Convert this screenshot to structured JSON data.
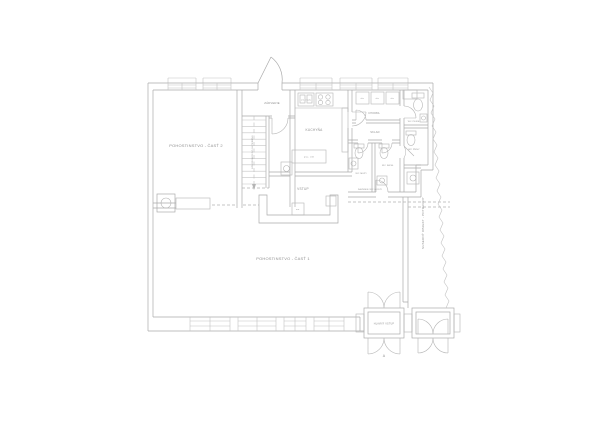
{
  "drawing": {
    "kind": "floor-plan",
    "colors": {
      "background": "#ffffff",
      "wall_line": "#ababab",
      "fixture_line": "#b5b5b5",
      "text": "#8f8f8f"
    },
    "labels": {
      "room_part2": "POHOSTINSTVO - ČASŤ 2",
      "room_part1": "POHOSTINSTVO - ČASŤ 1",
      "vestibule": "ZÁDVERIE",
      "kitchen": "KUCHYŇA",
      "entry": "VSTUP",
      "corridor": "CHODBA",
      "storage": "SKLAD",
      "wc_men": "WC MUŽI",
      "wc_disabled": "WC IMOB.",
      "wc_women": "WC ŽENY",
      "wc_staff": "WC PERS.",
      "back_area": "ZÁZEMIE WC HOSTÍ",
      "staircase": "SCHODISKO DO SUTERÉNU",
      "neighbor_building": "SUSEDNÝ OBJEKT - POTRAVINY",
      "main_entrance": "HLAVNÝ VSTUP",
      "section_marker": "A"
    },
    "fixture_labels": {
      "locker": "skr.",
      "dishwasher": "um. riadu",
      "worktable": "prac. stôl",
      "bar_washer": "um."
    }
  }
}
